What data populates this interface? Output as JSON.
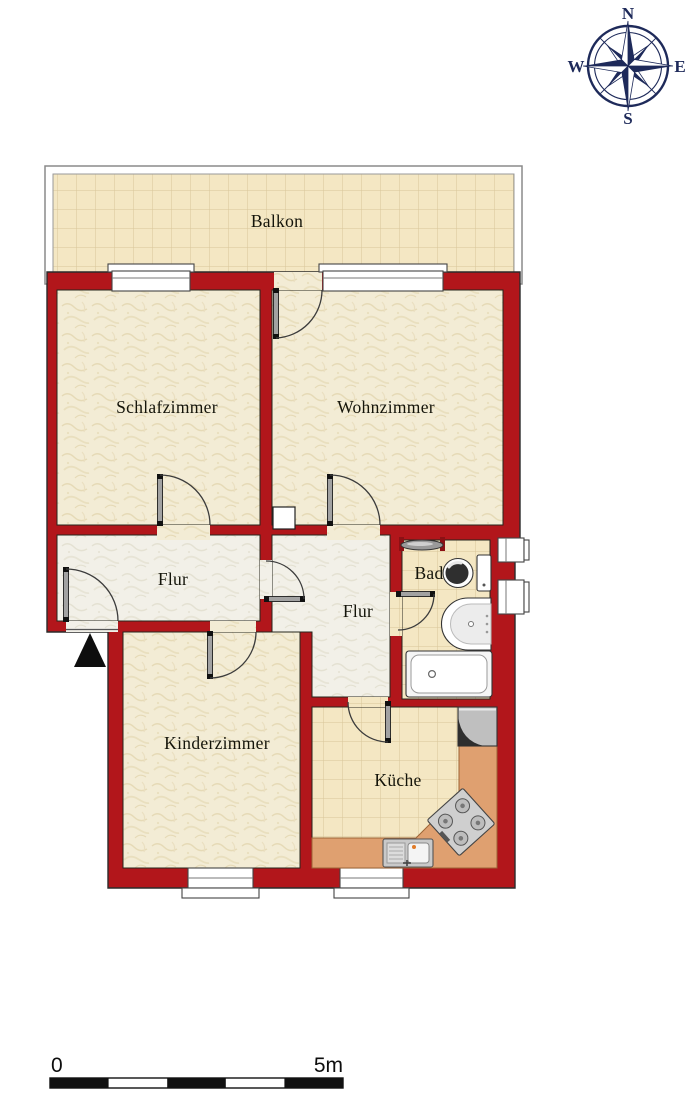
{
  "rooms": {
    "balkon": "Balkon",
    "schlafzimmer": "Schlafzimmer",
    "wohnzimmer": "Wohnzimmer",
    "flur_left": "Flur",
    "flur_right": "Flur",
    "bad": "Bad",
    "kinderzimmer": "Kinderzimmer",
    "kueche": "Küche"
  },
  "compass": {
    "north": "N",
    "east": "E",
    "south": "S",
    "west": "W"
  },
  "scale_bar": {
    "start": "0",
    "end": "5m"
  },
  "colors": {
    "wall": "#b2161b",
    "room_floor": "#f3ecd5",
    "hall_floor": "#f2f0e8",
    "tile_floor": "#f4e7c3",
    "tile_line": "#d8c69a",
    "counter": "#dfa070",
    "compass": "#1e2a5a"
  }
}
